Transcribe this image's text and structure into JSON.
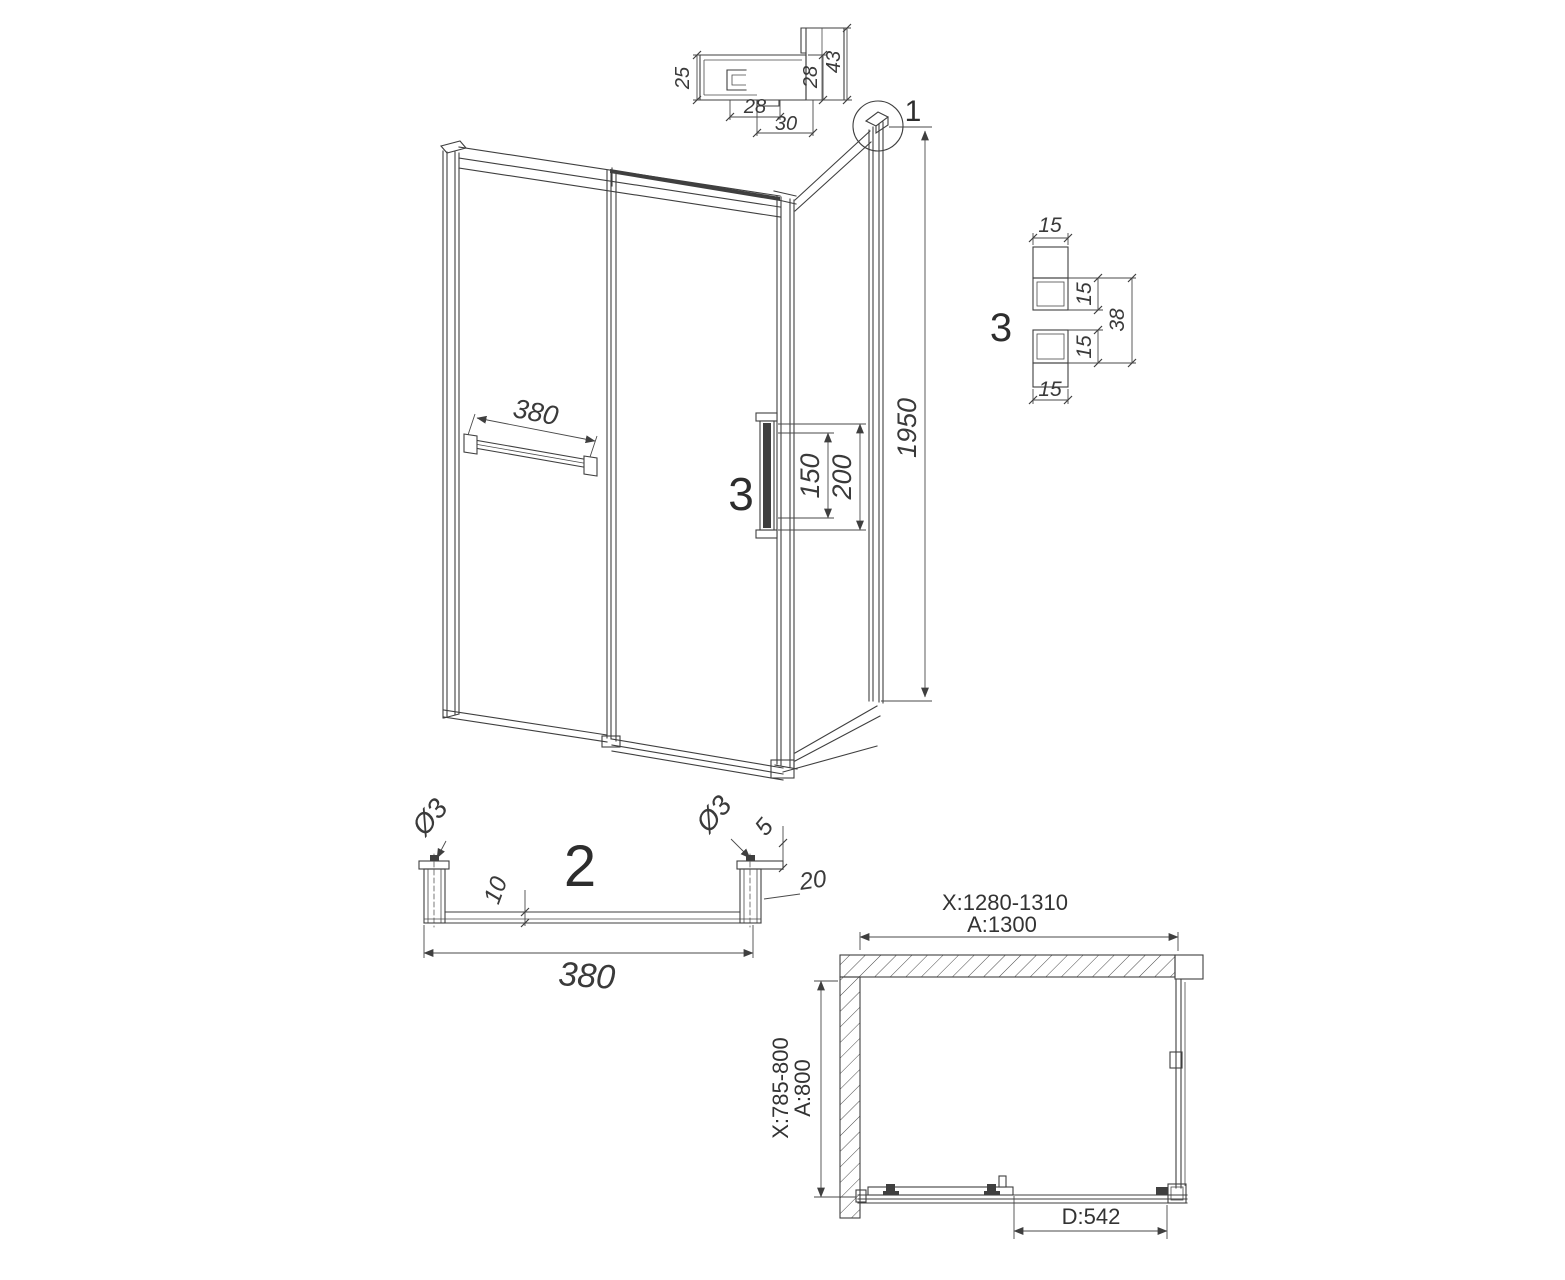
{
  "profile_detail": {
    "d25": "25",
    "d28_bottom": "28",
    "d30": "30",
    "d28_right": "28",
    "d43": "43"
  },
  "front_view": {
    "corner_callout": "1",
    "towel_bar_length": "380",
    "handle_callout": "3",
    "handle_hole_spacing": "150",
    "handle_length": "200",
    "height": "1950"
  },
  "corner_detail": {
    "callout": "3",
    "d15_top": "15",
    "d15_right_top": "15",
    "d15_right_bottom": "15",
    "d15_bottom": "15",
    "d38": "38"
  },
  "towel_bar_detail": {
    "callout": "2",
    "dia_left": "Ø3",
    "dia_right": "Ø3",
    "d5": "5",
    "d10": "10",
    "d20": "20",
    "length": "380"
  },
  "plan_view": {
    "width_range": "X:1280-1310",
    "width_nominal": "A:1300",
    "depth_range": "X:785-800",
    "depth_nominal": "A:800",
    "door_width": "D:542"
  }
}
